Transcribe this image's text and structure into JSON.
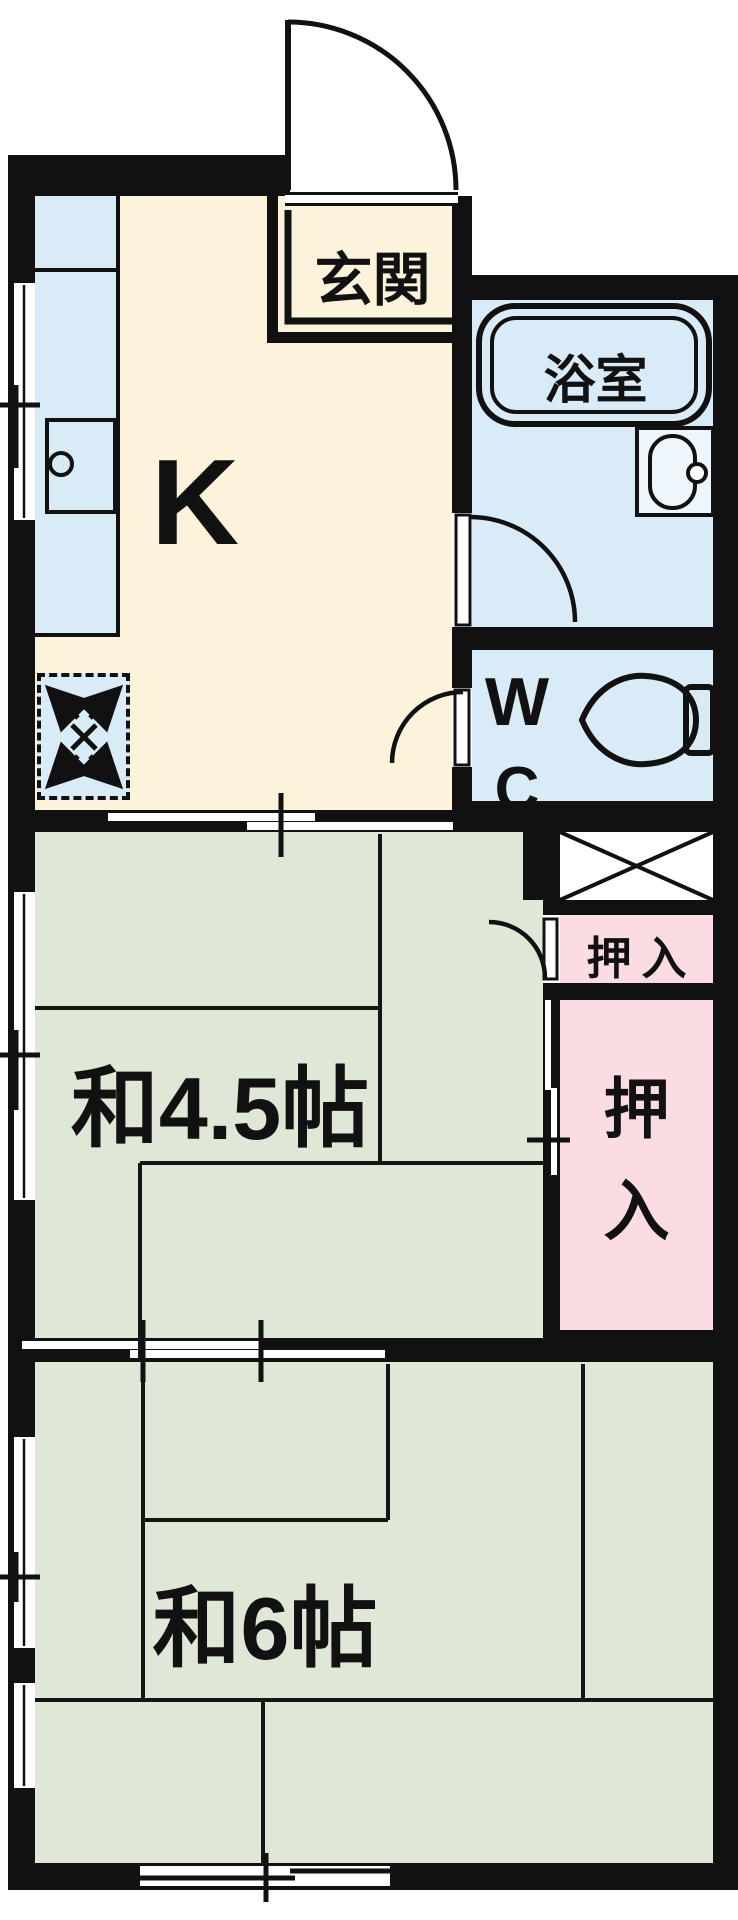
{
  "plan_title": "1K+2 Japanese apartment floor plan",
  "rooms": {
    "genkan": {
      "label": "玄関"
    },
    "kitchen": {
      "label": "K"
    },
    "bath": {
      "label": "浴室"
    },
    "wc": {
      "label_w": "W",
      "label_c": "C"
    },
    "closet_small": {
      "label": "押入"
    },
    "closet_large": {
      "char_top": "押",
      "char_bottom": "入"
    },
    "japanese_room_4_5": {
      "label": "和4.5帖"
    },
    "japanese_room_6": {
      "label": "和6帖"
    }
  },
  "icons": [
    "entrance-door-icon",
    "kitchen-sink-icon",
    "washing-machine-space-icon",
    "bathtub-icon",
    "washbasin-icon",
    "toilet-icon",
    "closet-cross-icon",
    "sliding-door-icon",
    "window-icon"
  ],
  "colors": {
    "bg": "#ffffff",
    "wall": "#111111",
    "kitchen": "#fcf3da",
    "water": "#d9ebf7",
    "tatami": "#dfe8d6",
    "closet": "#fbdce2",
    "line": "#151515"
  }
}
